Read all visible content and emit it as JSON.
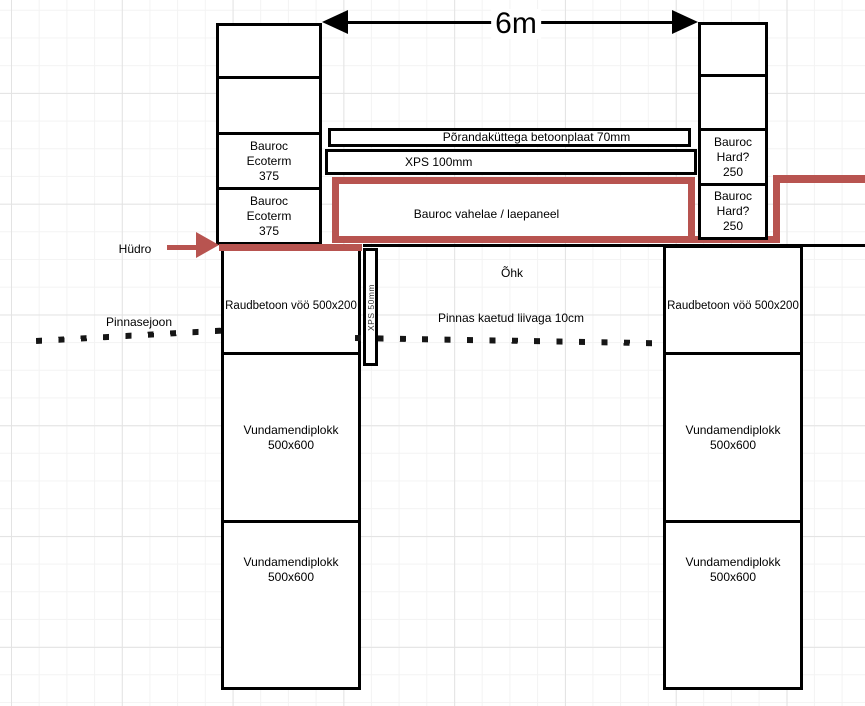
{
  "dimension": {
    "label": "6m"
  },
  "left_wall": {
    "block3": "Bauroc\nEcoterm\n375",
    "block4": "Bauroc\nEcoterm\n375"
  },
  "right_wall": {
    "block3": "Bauroc\nHard?\n250",
    "block4": "Bauroc\nHard?\n250"
  },
  "floor": {
    "screed": "Põrandaküttega betoonplaat 70mm",
    "insulation": "XPS 100mm",
    "panel": "Bauroc vahelae / laepaneel"
  },
  "labels": {
    "hydro": "Hüdro",
    "ground_line": "Pinnasejoon",
    "air": "Õhk",
    "sand": "Pinnas kaetud liivaga 10cm",
    "xps_strip": "XPS 50mm"
  },
  "left_foundation": {
    "beam": "Raudbetoon vöö 500x200",
    "block1": "Vundamendiplokk\n500x600",
    "block2": "Vundamendiplokk\n500x600"
  },
  "right_foundation": {
    "beam": "Raudbetoon vöö 500x200",
    "block1": "Vundamendiplokk\n500x600",
    "block2": "Vundamendiplokk\n500x600"
  },
  "colors": {
    "hydro_red": "#b85450"
  }
}
